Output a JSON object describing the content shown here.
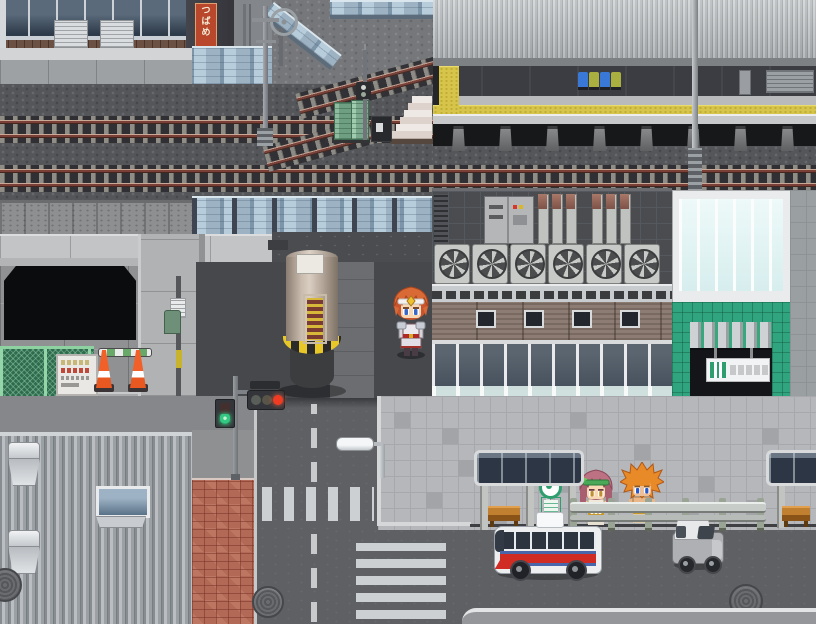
{
  "scene": {
    "genre": "pixel-art RPG town map",
    "setting": "city street beside an elevated train station with platform, viaduct, bus stop and intersection",
    "banner_sign": {
      "chars": [
        "つ",
        "ば",
        "め"
      ],
      "bg": "#b8472b",
      "fg": "#f4ecd8"
    },
    "station_sign": {
      "accent": "#2fa47e",
      "label_blocks": 5
    },
    "palette": {
      "platform_tactile_yellow": "#d6c54a",
      "station_green": "#2fa47e",
      "bus_red": "#d02c24",
      "bus_blue": "#4a66aa",
      "cone_orange": "#e85820",
      "signal_red_lit": "#ef3b22",
      "walk_green_lit": "#35c882",
      "noise_barrier_blue": "#b7cddc",
      "seat_blue": "#3a78d8",
      "seat_olive": "#aab040"
    },
    "characters": [
      {
        "name": "hero",
        "description": "orange-haired adventurer with white headband standing under the viaduct"
      },
      {
        "name": "npc-girl",
        "description": "pink-haired woman with green headband waiting at the bus stop"
      },
      {
        "name": "npc-man",
        "description": "spiky orange-haired man waiting at the bus stop"
      }
    ],
    "vehicles": [
      {
        "name": "bus",
        "description": "white city bus with red and blue stripes, heading west"
      },
      {
        "name": "van",
        "description": "small gray van with white roof on the east road"
      }
    ],
    "props": [
      "platform-roof",
      "platform-seats",
      "tactile-paving",
      "stairs",
      "signal-pole",
      "utility-boxes",
      "catenary-poles",
      "noise-barriers",
      "viaduct",
      "underpass",
      "support-pillar",
      "mesh-fence",
      "notice-board",
      "traffic-cones",
      "rooftop-fans",
      "rooftop-pipes",
      "electrical-cabinets",
      "glass-curtain-wall",
      "station-entrance",
      "hanging-station-sign",
      "hazard-posts",
      "bus-shelter",
      "bench",
      "bus-stop-sign",
      "guardrail",
      "street-lamp",
      "traffic-light",
      "pedestrian-signal",
      "crosswalks",
      "manholes",
      "brick-pavement",
      "corrugated-warehouse",
      "roof-vents"
    ]
  }
}
